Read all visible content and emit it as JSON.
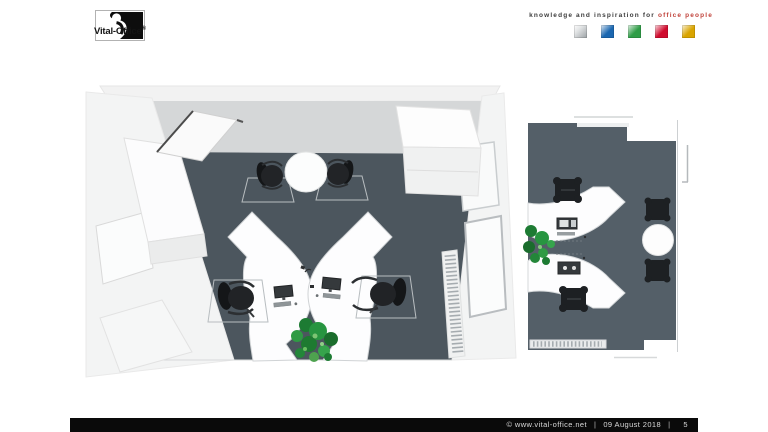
{
  "header": {
    "logo": {
      "text": "Vital-Office",
      "registered": "®"
    },
    "tagline": {
      "black": "knowledge and inspiration for",
      "red": "office people",
      "red_color": "#c0423a"
    },
    "palette": [
      {
        "name": "silver",
        "hex": "#9ba1a4"
      },
      {
        "name": "blue",
        "hex": "#1b67b0"
      },
      {
        "name": "green",
        "hex": "#2f9d47"
      },
      {
        "name": "red",
        "hex": "#d00c2e"
      },
      {
        "name": "gold",
        "hex": "#d9a400"
      }
    ]
  },
  "content": {
    "left_render": {
      "alt": "3D top view of office with two curved desks, round meeting table and door",
      "floor_color": "#4c565e"
    },
    "right_render": {
      "alt": "2D floor plan with two curved desks, plant and round meeting table",
      "floor_color": "#545f68"
    }
  },
  "footer": {
    "copyright": "©  www.vital-office.net",
    "separator": "|",
    "date": "09 August 2018",
    "page": "5",
    "bar_color": "#0a0a0a"
  }
}
